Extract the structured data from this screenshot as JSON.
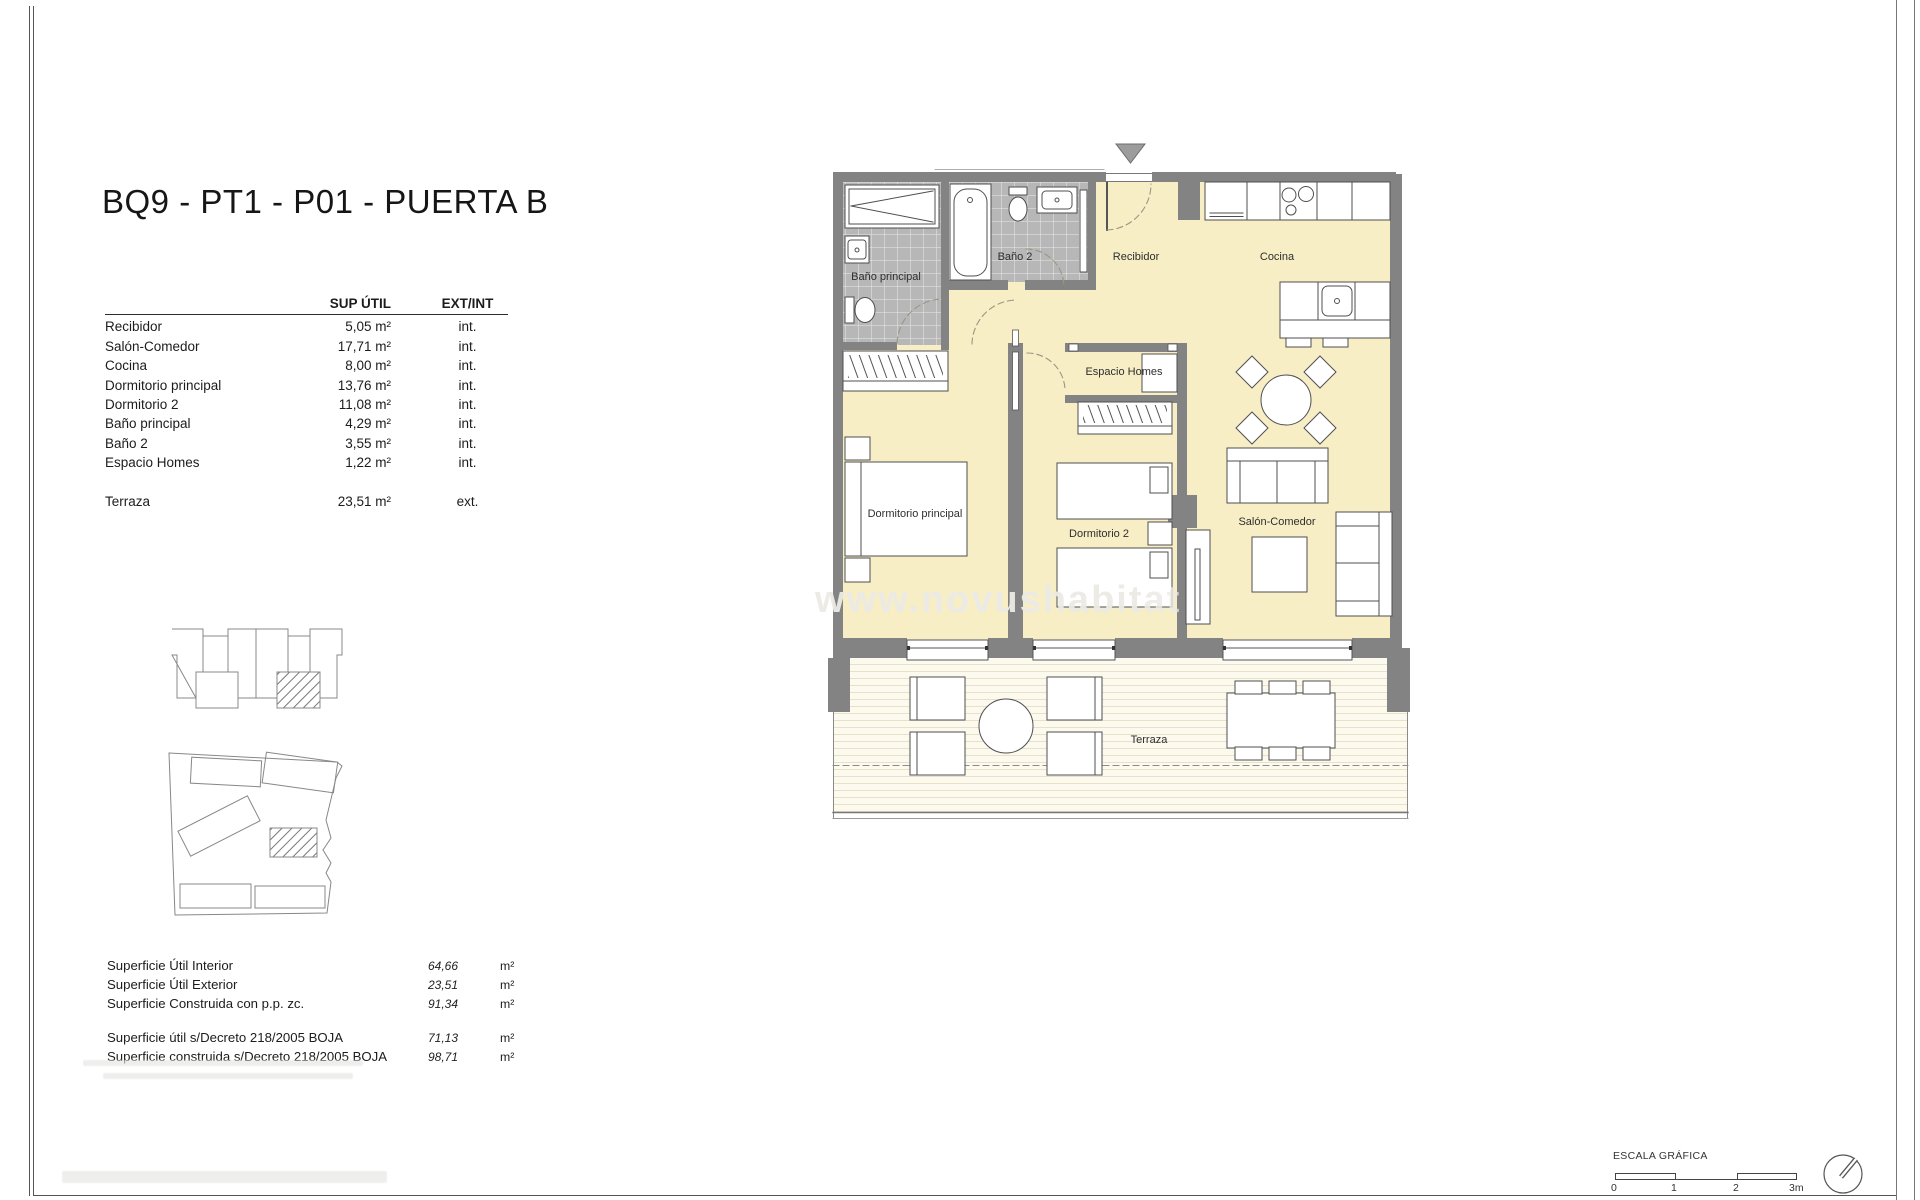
{
  "title": "BQ9 - PT1 - P01 - PUERTA B",
  "area_table": {
    "headers": {
      "area": "SUP ÚTIL",
      "extint": "EXT/INT"
    },
    "rows": [
      {
        "label": "Recibidor",
        "area": "5,05 m²",
        "type": "int."
      },
      {
        "label": "Salón-Comedor",
        "area": "17,71 m²",
        "type": "int."
      },
      {
        "label": "Cocina",
        "area": "8,00 m²",
        "type": "int."
      },
      {
        "label": "Dormitorio principal",
        "area": "13,76 m²",
        "type": "int."
      },
      {
        "label": "Dormitorio 2",
        "area": "11,08 m²",
        "type": "int."
      },
      {
        "label": "Baño principal",
        "area": "4,29 m²",
        "type": "int."
      },
      {
        "label": "Baño 2",
        "area": "3,55 m²",
        "type": "int."
      },
      {
        "label": "Espacio Homes",
        "area": "1,22 m²",
        "type": "int."
      }
    ],
    "terrace_row": {
      "label": "Terraza",
      "area": "23,51 m²",
      "type": "ext."
    }
  },
  "summary": {
    "rows": [
      {
        "label": "Superficie Útil Interior",
        "value": "64,66",
        "unit": "m²"
      },
      {
        "label": "Superficie Útil Exterior",
        "value": "23,51",
        "unit": "m²"
      },
      {
        "label": "Superficie Construida con p.p. zc.",
        "value": "91,34",
        "unit": "m²"
      }
    ],
    "decreto_rows": [
      {
        "label": "Superficie útil s/Decreto 218/2005 BOJA",
        "value": "71,13",
        "unit": "m²"
      },
      {
        "label": "Superficie construida s/Decreto 218/2005 BOJA",
        "value": "98,71",
        "unit": "m²"
      }
    ]
  },
  "plan": {
    "rooms": {
      "bano_principal": "Baño principal",
      "bano2": "Baño 2",
      "recibidor": "Recibidor",
      "cocina": "Cocina",
      "espacio_homes": "Espacio Homes",
      "dormitorio_principal": "Dormitorio principal",
      "dormitorio2": "Dormitorio 2",
      "salon": "Salón-Comedor",
      "terraza": "Terraza"
    },
    "watermark": "www.novushabitat"
  },
  "scale_bar": {
    "title": "ESCALA GRÁFICA",
    "ticks": [
      "0",
      "1",
      "2",
      "3m"
    ]
  },
  "colors": {
    "room_fill": "#f7eec6",
    "tile_fill": "#b7b7b7",
    "wall": "#838383",
    "deck_stripe": "#e9e1c6",
    "entrance_marker": "#9c9c9c"
  }
}
